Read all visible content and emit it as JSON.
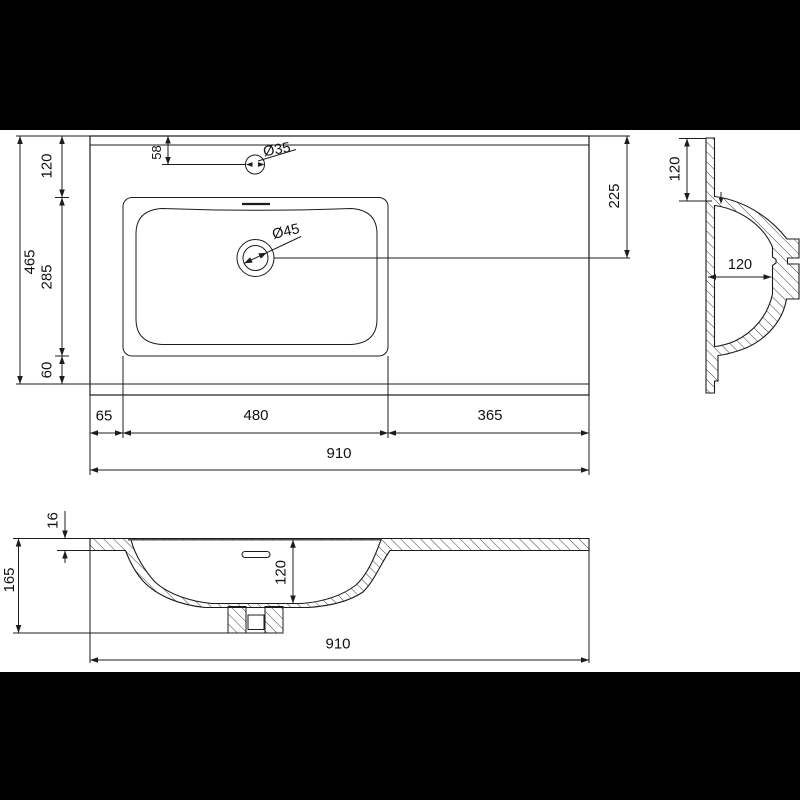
{
  "drawing": {
    "type": "technical-drawing",
    "subject": "rectangular inset washbasin with left-positioned bowl",
    "colors": {
      "line": "#1c1c1c",
      "paper": "#ffffff",
      "letterbox": "#000000"
    },
    "plan": {
      "depth_total": "465",
      "back_offset": "120",
      "basin_depth": "285",
      "front_offset": "60",
      "faucet_offset": "58",
      "faucet_diameter": "Ø35",
      "drain_diameter": "Ø45",
      "drain_offset_right": "225",
      "left_offset": "65",
      "basin_width": "480",
      "right_offset": "365",
      "total_width": "910"
    },
    "side": {
      "rim_height": "120",
      "bowl_inner_width": "120"
    },
    "front": {
      "top_thickness": "16",
      "total_height": "165",
      "bowl_depth": "120",
      "total_width": "910"
    }
  }
}
